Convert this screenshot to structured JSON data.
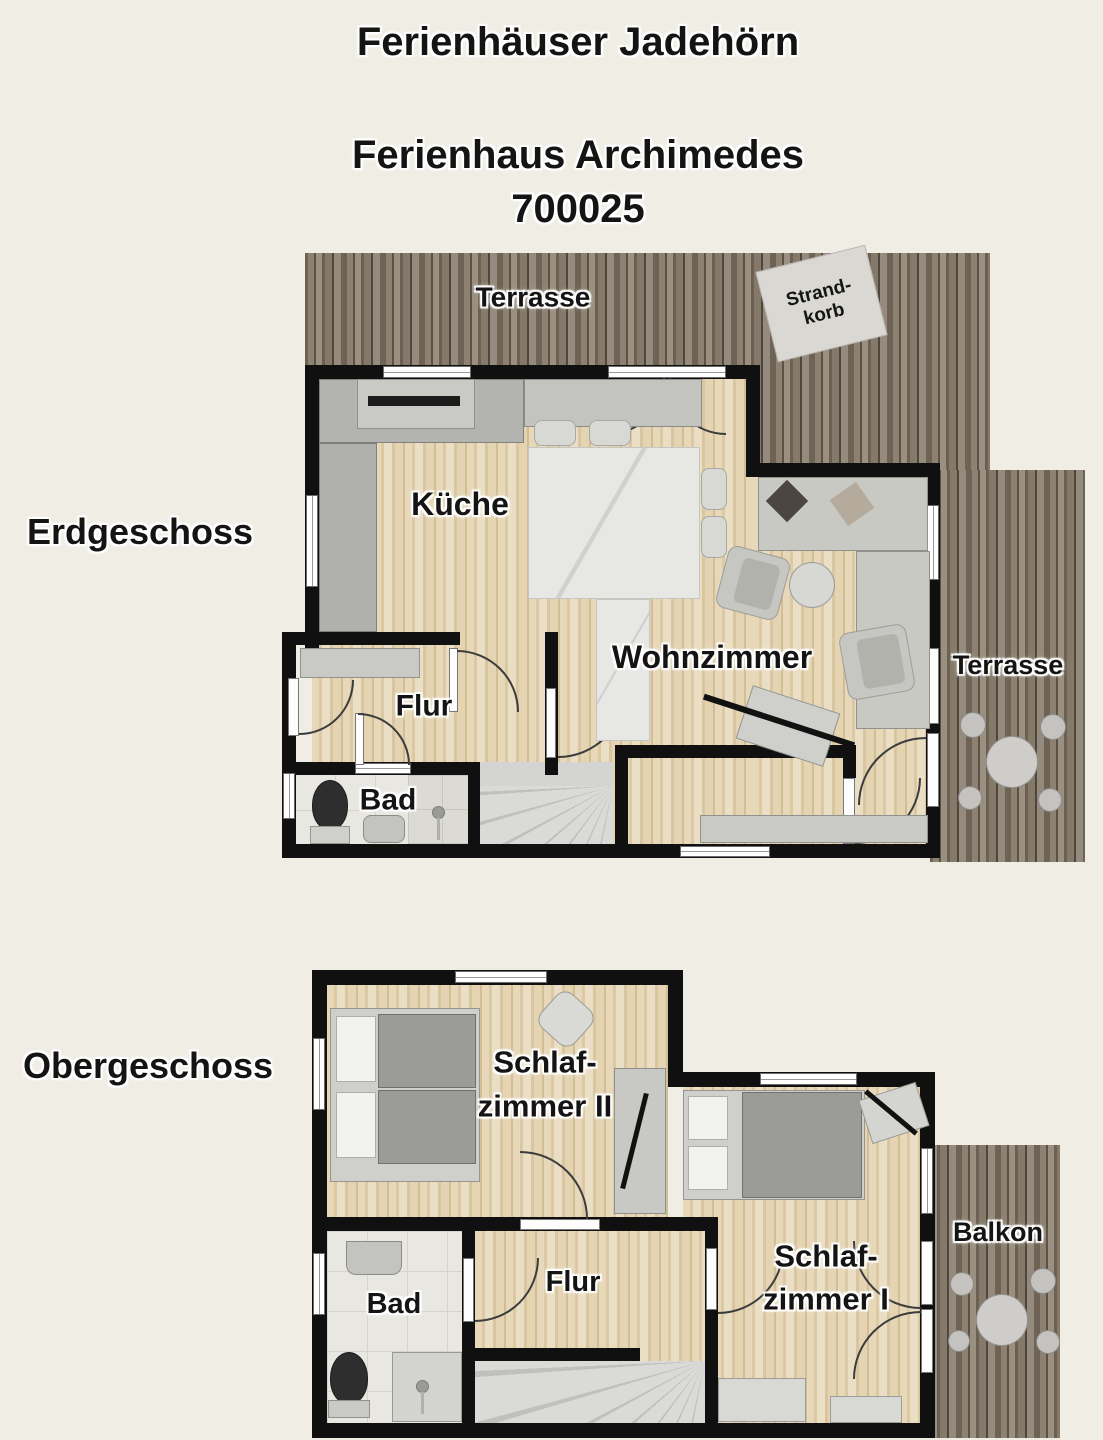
{
  "page": {
    "background": "#f0ede5"
  },
  "header": {
    "project_title": "Ferienhäuser Jadehörn",
    "house_title": "Ferienhaus Archimedes",
    "house_id": "700025"
  },
  "ground_floor": {
    "floor_label": "Erdgeschoss",
    "terrace_top_label": "Terrasse",
    "terrace_right_label": "Terrasse",
    "beach_chair_label_line1": "Strand-",
    "beach_chair_label_line2": "korb",
    "kitchen_label": "Küche",
    "living_room_label": "Wohnzimmer",
    "hallway_label": "Flur",
    "bathroom_label": "Bad"
  },
  "upper_floor": {
    "floor_label": "Obergeschoss",
    "bedroom2_label_line1": "Schlaf-",
    "bedroom2_label_line2": "zimmer II",
    "bedroom1_label_line1": "Schlaf-",
    "bedroom1_label_line2": "zimmer I",
    "hallway_label": "Flur",
    "bathroom_label": "Bad",
    "balcony_label": "Balkon"
  },
  "colors": {
    "background": "#f0ede5",
    "wall": "#101010",
    "wood_floor": "#e6d6b5",
    "deck_wood": "#7f7466",
    "furniture": "#c6c6c2",
    "label_text": "#141414"
  }
}
